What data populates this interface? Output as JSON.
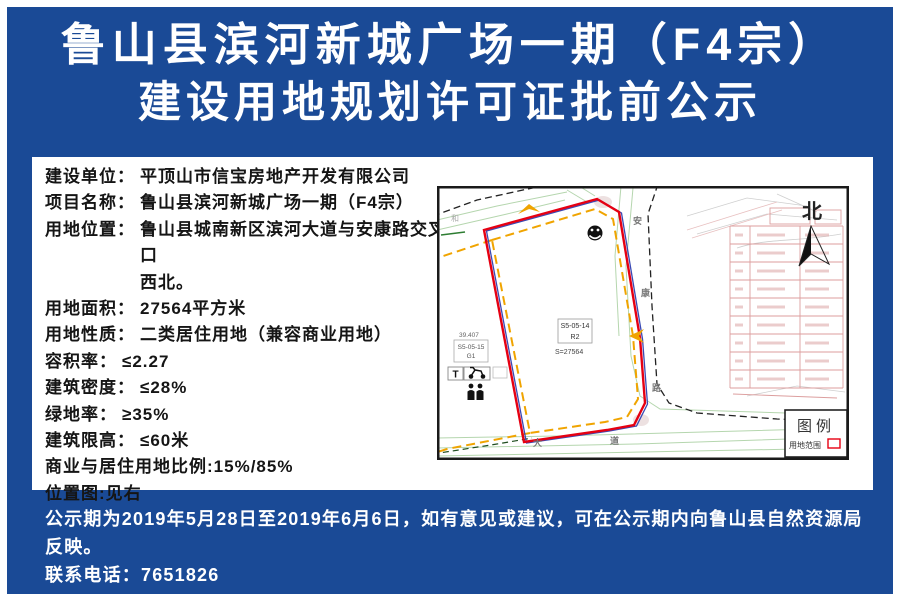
{
  "colors": {
    "background_blue": "#1a4a96",
    "boundary_red": "#e60012",
    "setback_orange": "#f0a400",
    "inner_blue": "#3a49b4",
    "parcel_pink": "#dc9e9e",
    "terrain_green": "#b5d6ae",
    "text_white": "#ffffff",
    "text_black": "#151515"
  },
  "title": {
    "line1": "鲁山县滨河新城广场一期（F4宗）",
    "line2": "建设用地规划许可证批前公示"
  },
  "info": {
    "rows": [
      {
        "label": "建设单位：",
        "value": "平顶山市信宝房地产开发有限公司"
      },
      {
        "label": "项目名称：",
        "value": "鲁山县滨河新城广场一期（F4宗）"
      },
      {
        "label": "用地位置：",
        "value": "鲁山县城南新区滨河大道与安康路交叉口",
        "value2": "西北。"
      },
      {
        "label": "用地面积：",
        "value": "27564平方米"
      },
      {
        "label": "用地性质：",
        "value": "二类居住用地（兼容商业用地）"
      },
      {
        "label": "容积率：",
        "value": "≤2.27"
      },
      {
        "label": "建筑密度：",
        "value": "≤28%"
      },
      {
        "label": "绿地率：",
        "value": "≥35%"
      },
      {
        "label": "建筑限高：",
        "value": "≤60米"
      },
      {
        "label": "商业与居住用地比例:",
        "value": "15%/85%"
      },
      {
        "label": "位置图:",
        "value": "见右"
      }
    ]
  },
  "map": {
    "north_label": "北",
    "legend_title": "图例",
    "legend_item": "用地范围",
    "road_vertical_1": "安",
    "road_vertical_2": "康",
    "road_vertical_3": "路",
    "road_bottom_1": "大",
    "road_bottom_2": "道",
    "site_code": "S5-05-14",
    "site_use": "R2",
    "site_area": "S=27564",
    "adjacent_elev": "39.407",
    "adjacent_code": "S5-05-15",
    "adjacent_use": "G1",
    "t_marker": "T",
    "corner_char": "和"
  },
  "notice": {
    "line1": "公示期为2019年5月28日至2019年6月6日，如有意见或建议，可在公示期内向鲁山县自然资源局反映。",
    "line2": "联系电话：7651826"
  }
}
